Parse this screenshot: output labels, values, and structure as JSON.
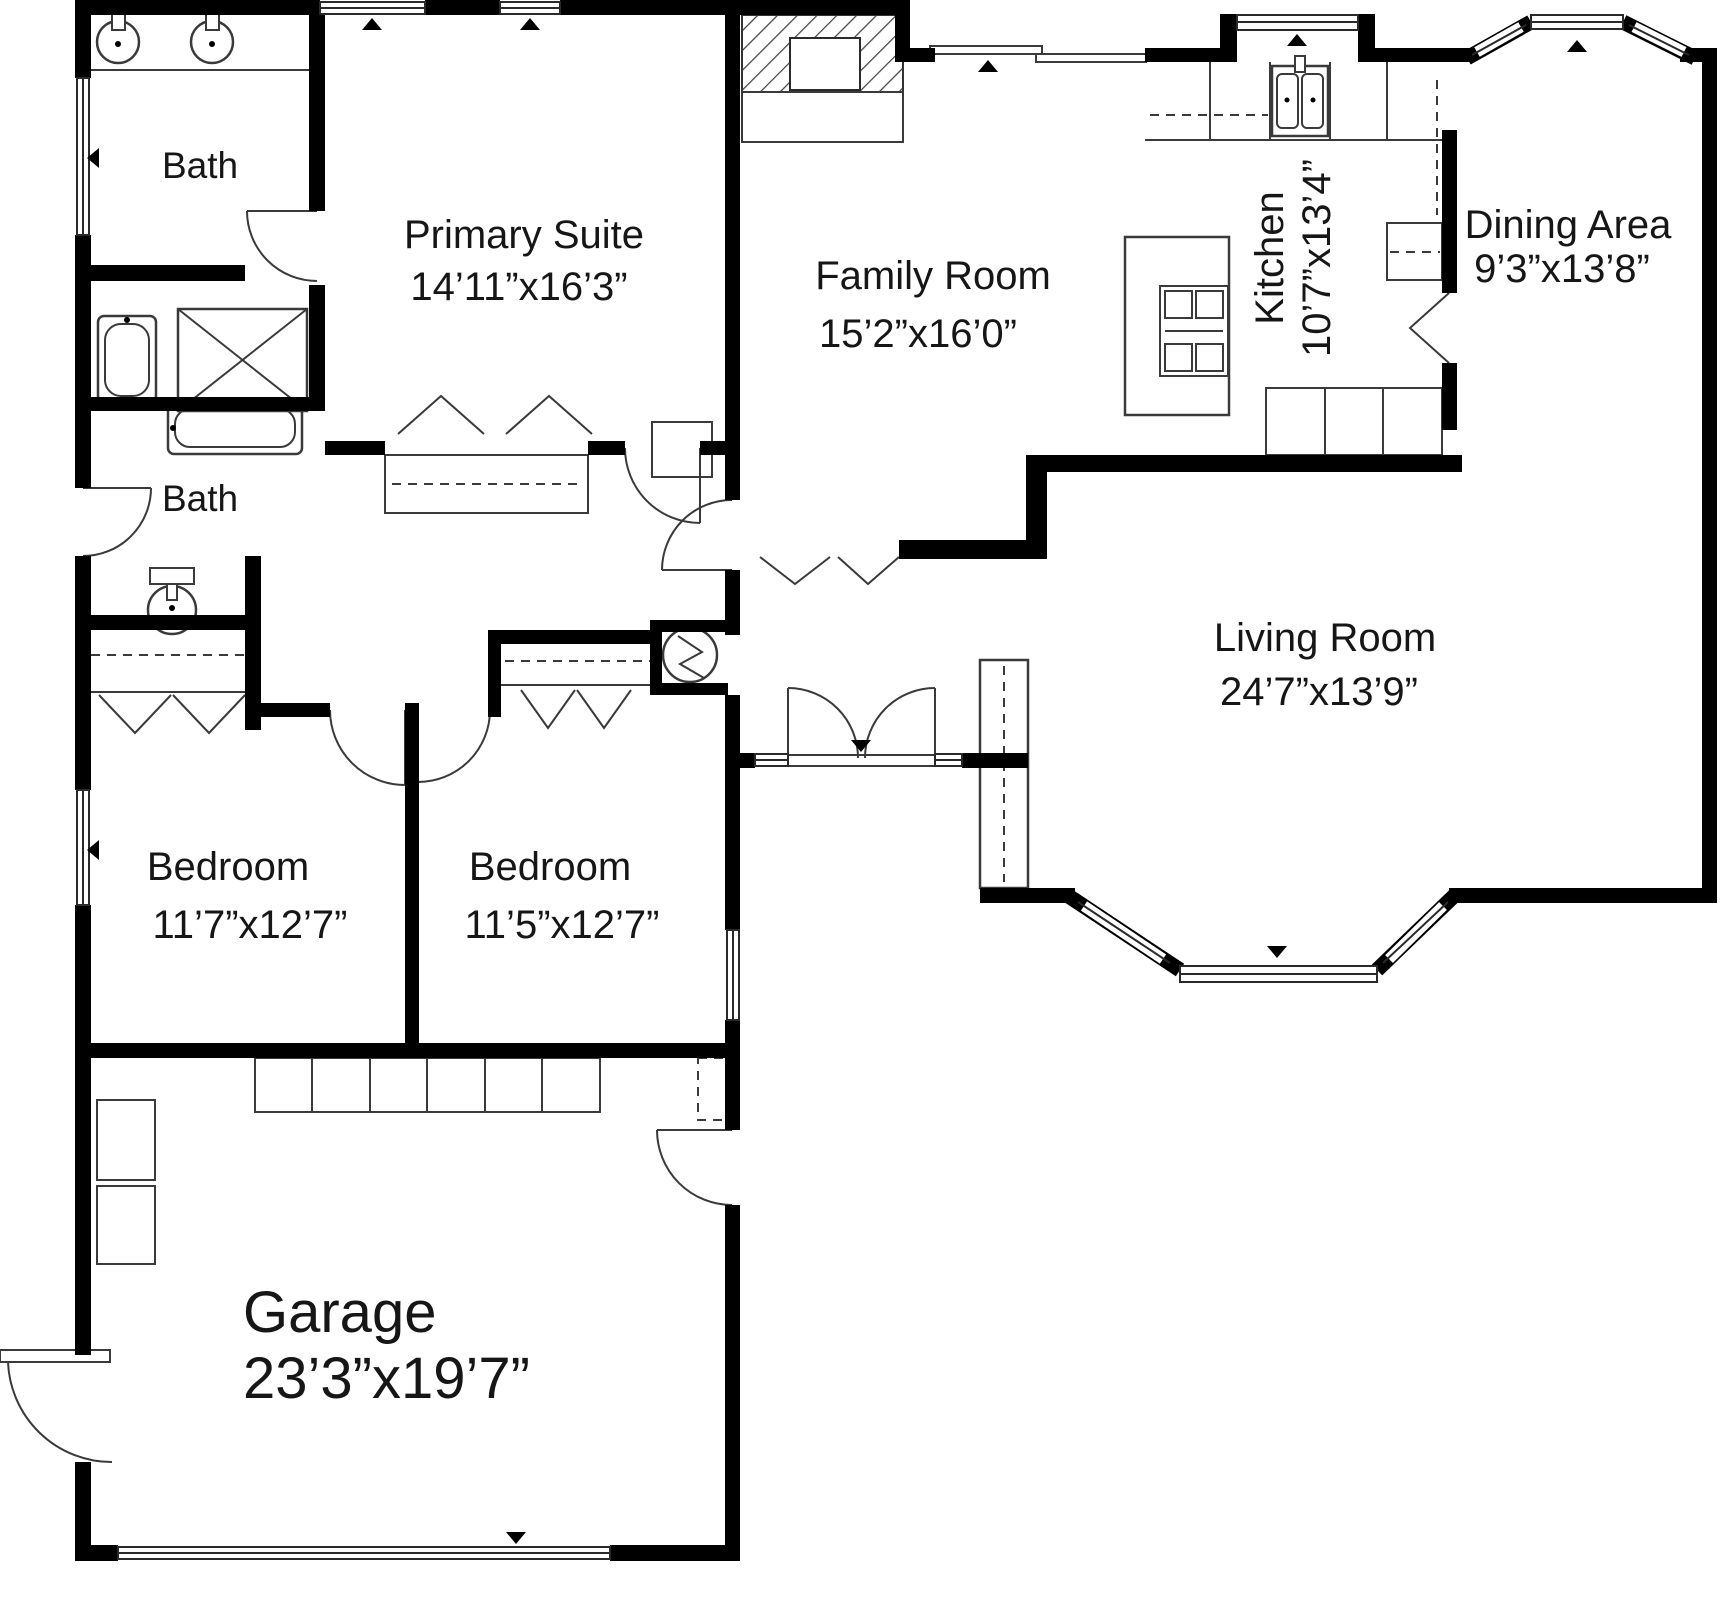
{
  "plan_title": "Single-story house floor plan",
  "rooms": {
    "bath_top": {
      "name": "Bath",
      "dims": ""
    },
    "primary_suite": {
      "name": "Primary Suite",
      "dims": "14’11”x16’3”"
    },
    "family_room": {
      "name": "Family Room",
      "dims": "15’2”x16’0”"
    },
    "kitchen": {
      "name": "Kitchen",
      "dims": "10’7”x13’4”"
    },
    "dining_area": {
      "name": "Dining Area",
      "dims": "9’3”x13’8”"
    },
    "bath_mid": {
      "name": "Bath",
      "dims": ""
    },
    "living_room": {
      "name": "Living Room",
      "dims": "24’7”x13’9”"
    },
    "bedroom_left": {
      "name": "Bedroom",
      "dims": "11’7”x12’7”"
    },
    "bedroom_right": {
      "name": "Bedroom",
      "dims": "11’5”x12’7”"
    },
    "garage": {
      "name": "Garage",
      "dims": "23’3”x19’7”"
    }
  },
  "fixtures": [
    "double-vanity-sinks",
    "bathtub-vertical",
    "shower-stall",
    "toilet",
    "bathtub-horizontal",
    "water-heater",
    "fireplace",
    "cooktop-island",
    "kitchen-double-sink",
    "base-cabinets",
    "garage-storage-cabinets",
    "bay-window-dining",
    "bay-window-living",
    "entry-double-door",
    "garage-door",
    "sliding-patio-door"
  ],
  "colors": {
    "wall": "#000000",
    "line": "#3a3a3a",
    "background": "#ffffff",
    "text": "#161616"
  }
}
